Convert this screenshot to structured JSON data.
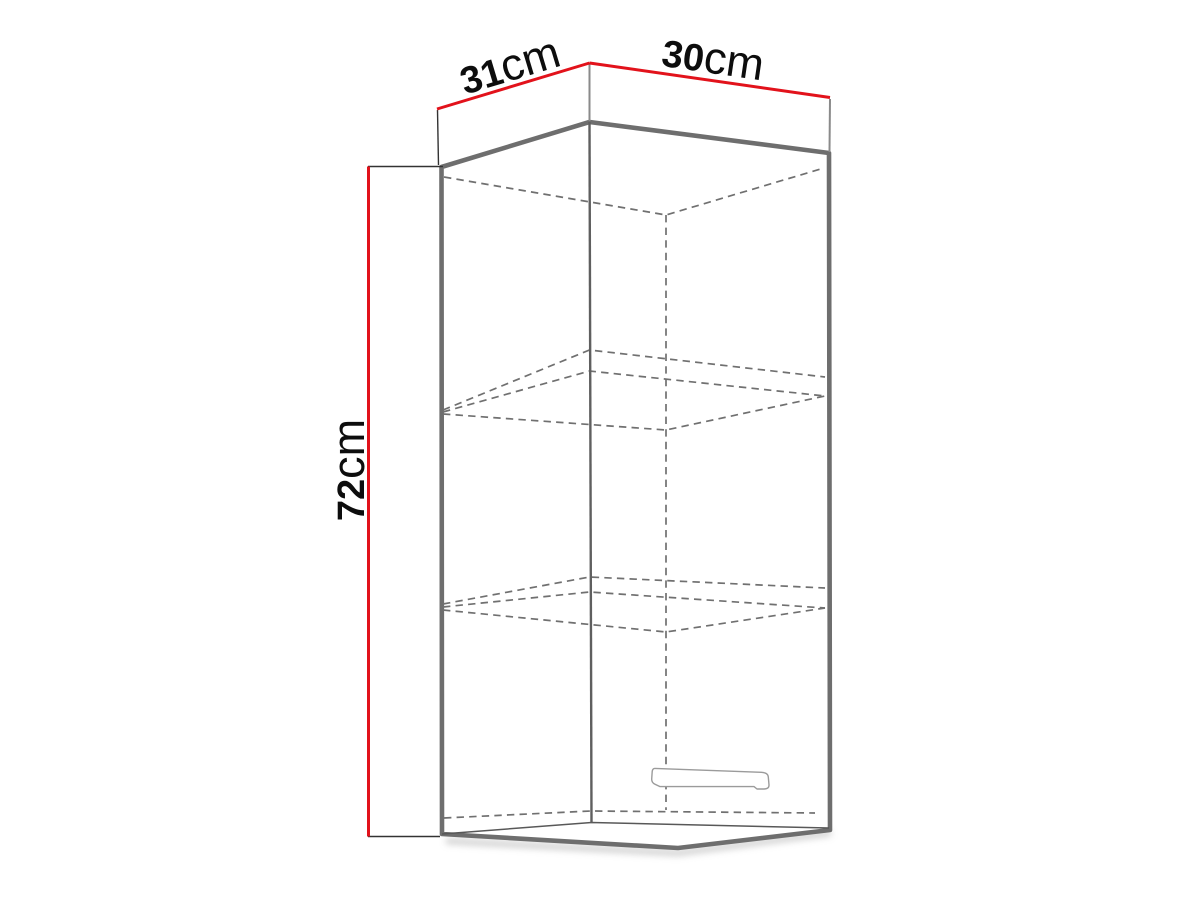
{
  "dimensions": {
    "depth": {
      "value": "31",
      "unit": "cm"
    },
    "width": {
      "value": "30",
      "unit": "cm"
    },
    "height": {
      "value": "72",
      "unit": "cm"
    }
  },
  "colors": {
    "dimension_line": "#e2121b",
    "cabinet_edge": "#6e6e6e",
    "hidden_edge_dashed": "#707070",
    "label_text": "#0d0d0d",
    "background": "#ffffff"
  }
}
